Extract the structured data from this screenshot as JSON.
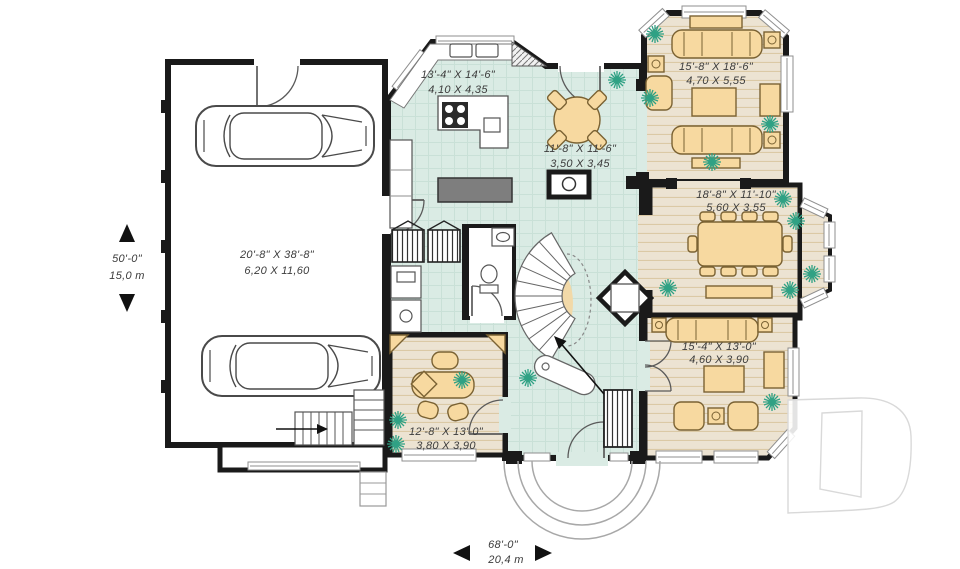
{
  "rooms": {
    "garage": {
      "imperial": "20'-8\" X 38'-8\"",
      "metric": "6,20 X 11,60"
    },
    "kitchen": {
      "imperial": "13'-4\" X 14'-6\"",
      "metric": "4,10 X 4,35"
    },
    "breakfast_nook": {
      "imperial": "11'-8\" X 11'-6\"",
      "metric": "3,50 X 3,45"
    },
    "living_room": {
      "imperial": "15'-8\" X 18'-6\"",
      "metric": "4,70 X 5,55"
    },
    "dining_room": {
      "imperial": "18'-8\" X 11'-10\"",
      "metric": "5,60 X 3,55"
    },
    "family_room": {
      "imperial": "15'-4\" X 13'-0\"",
      "metric": "4,60 X 3,90"
    },
    "office": {
      "imperial": "12'-8\" X 13'-0\"",
      "metric": "3,80 X 3,90"
    }
  },
  "overall": {
    "depth_imperial": "50'-0\"",
    "depth_metric": "15,0 m",
    "width_imperial": "68'-0\"",
    "width_metric": "20,4 m"
  },
  "colors": {
    "wall": "#1a1a1a",
    "tile_floor": "#daebe4",
    "wood_floor": "#ece3d2",
    "furniture": "#f7d9a0",
    "plant": "#2fa184",
    "watermark_outline": "#d9d9d9"
  }
}
